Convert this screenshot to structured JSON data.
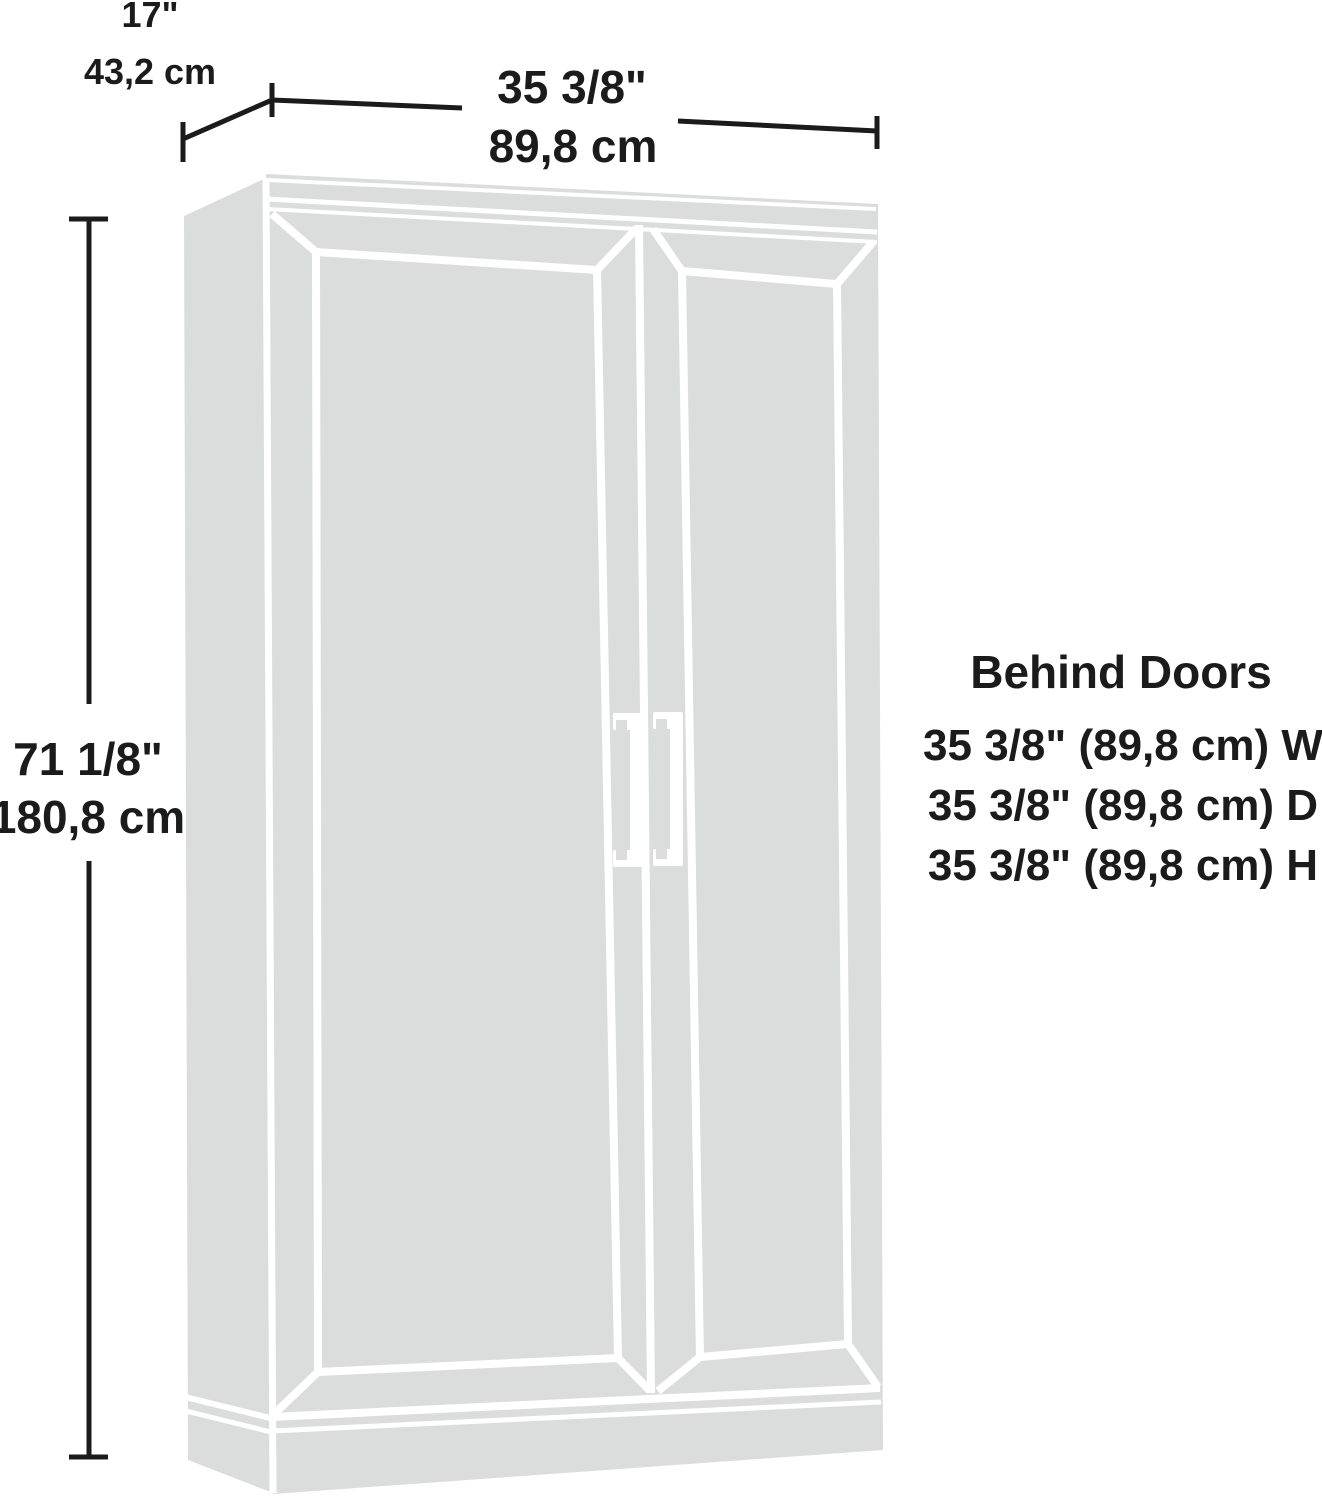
{
  "diagram": {
    "depth": {
      "inches": "17\"",
      "cm": "43,2 cm"
    },
    "width": {
      "inches": "35 3/8\"",
      "cm": "89,8 cm"
    },
    "height": {
      "inches": "71 1/8\"",
      "cm": "180,8 cm"
    },
    "behind_doors": {
      "title": "Behind Doors",
      "line_w": "35 3/8\" (89,8 cm) W",
      "line_d": "35 3/8\" (89,8 cm) D",
      "line_h": "35 3/8\" (89,8 cm) H"
    },
    "colors": {
      "cabinet_fill": "#dbdcdc",
      "line": "#ffffff",
      "dimension": "#1b1b1b",
      "background": "#ffffff"
    }
  }
}
